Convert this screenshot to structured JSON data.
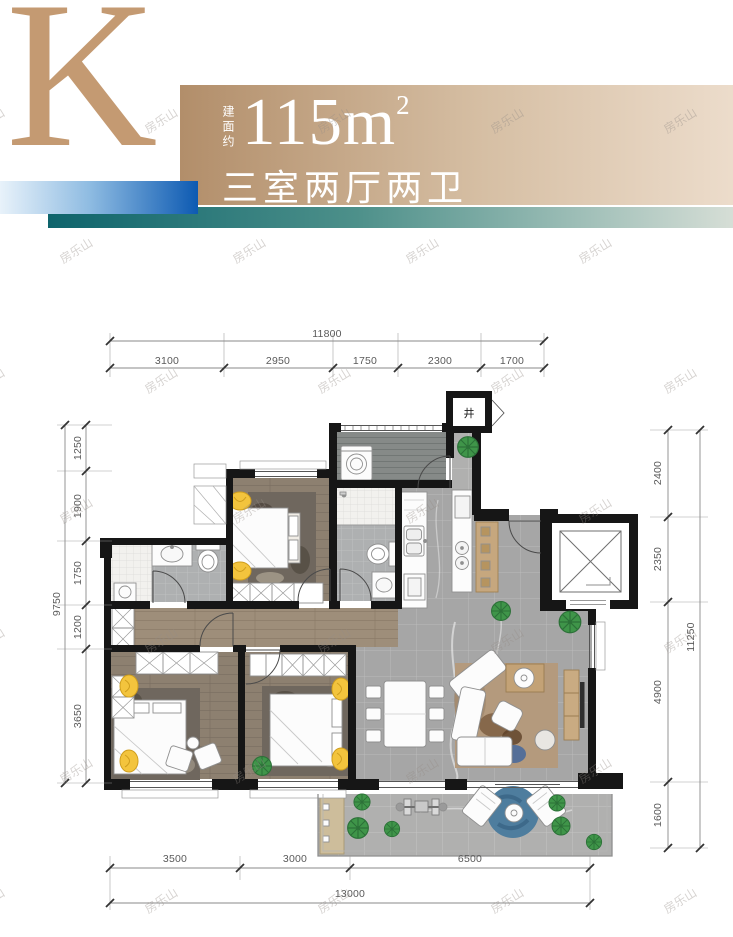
{
  "header": {
    "unit_letter": "K",
    "area_prefix": "建面约",
    "area_value": "115m",
    "area_sup": "2",
    "layout_text": "三室两厅两卫"
  },
  "watermark": {
    "text": "房乐山"
  },
  "plan": {
    "shaft_label": "井",
    "dims": {
      "top": {
        "total": "11800",
        "segments": [
          "3100",
          "2950",
          "1750",
          "2300",
          "1700"
        ]
      },
      "left": {
        "total": "9750",
        "segments": [
          "1250",
          "1900",
          "1750",
          "1200",
          "3650"
        ]
      },
      "right": {
        "total": "11250",
        "segments": [
          "2400",
          "2350",
          "4900",
          "1600"
        ]
      },
      "bottom": {
        "total": "13000",
        "segments": [
          "3500",
          "3000",
          "6500"
        ]
      }
    }
  },
  "theme": {
    "tan": "#c49a72",
    "banner-from": "#b28e6a",
    "banner-to": "#ecdccb",
    "blue-to": "#0d5ab2",
    "teal-from": "#0e646c",
    "wall": "#161616",
    "marble": "#a6a6a6",
    "wood": "#8d8070",
    "accent-yellow": "#f3c43d",
    "plant": "#3f9549"
  }
}
